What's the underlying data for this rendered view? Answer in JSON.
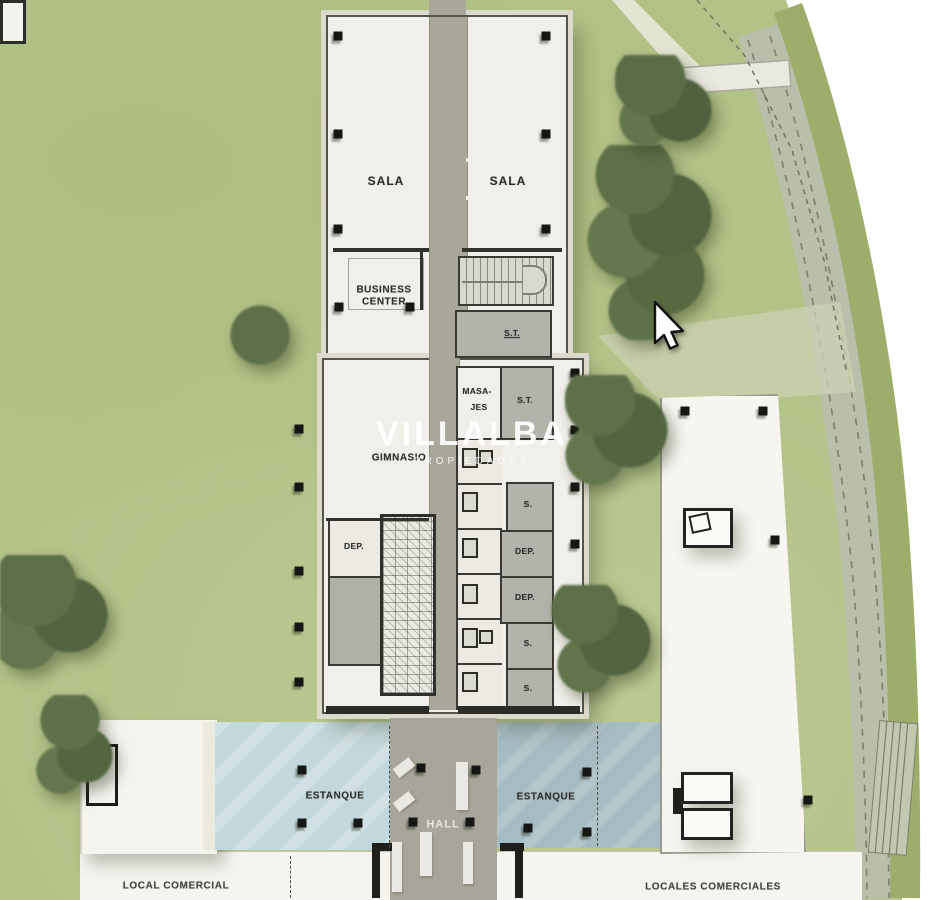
{
  "watermark": {
    "brand": "VILLALBA",
    "subtitle": "PROPIEDADES"
  },
  "rooms": {
    "sala_left": "SALA",
    "sala_right": "SALA",
    "business_center": "BUSINESS CENTER",
    "st_top": "S.T.",
    "st_mid": "S.T.",
    "masajes_l1": "MASA-",
    "masajes_l2": "JES",
    "gimnasio": "GIMNASIO",
    "dep_left": "DEP.",
    "dep_1": "DEP.",
    "dep_2": "DEP.",
    "s_1": "S.",
    "s_2": "S.",
    "s_3": "S."
  },
  "ground": {
    "estanque_left": "ESTANQUE",
    "estanque_right": "ESTANQUE",
    "hall": "HALL",
    "local_comercial": "LOCAL COMERCIAL",
    "locales_comerciales": "LOCALES COMERCIALES"
  },
  "cursor": {
    "type": "arrow-pointer"
  },
  "colors": {
    "grass": "#b3c287",
    "foliage": "#5d7048",
    "pond_left": "#c3d8dc",
    "pond_right": "#a6bcc3",
    "corridor": "#a8a79a",
    "room_gray": "#b4b3ab",
    "wall": "#33332e",
    "floor": "#f0efe9",
    "road": "#b9bfaa",
    "page": "#ffffff"
  }
}
